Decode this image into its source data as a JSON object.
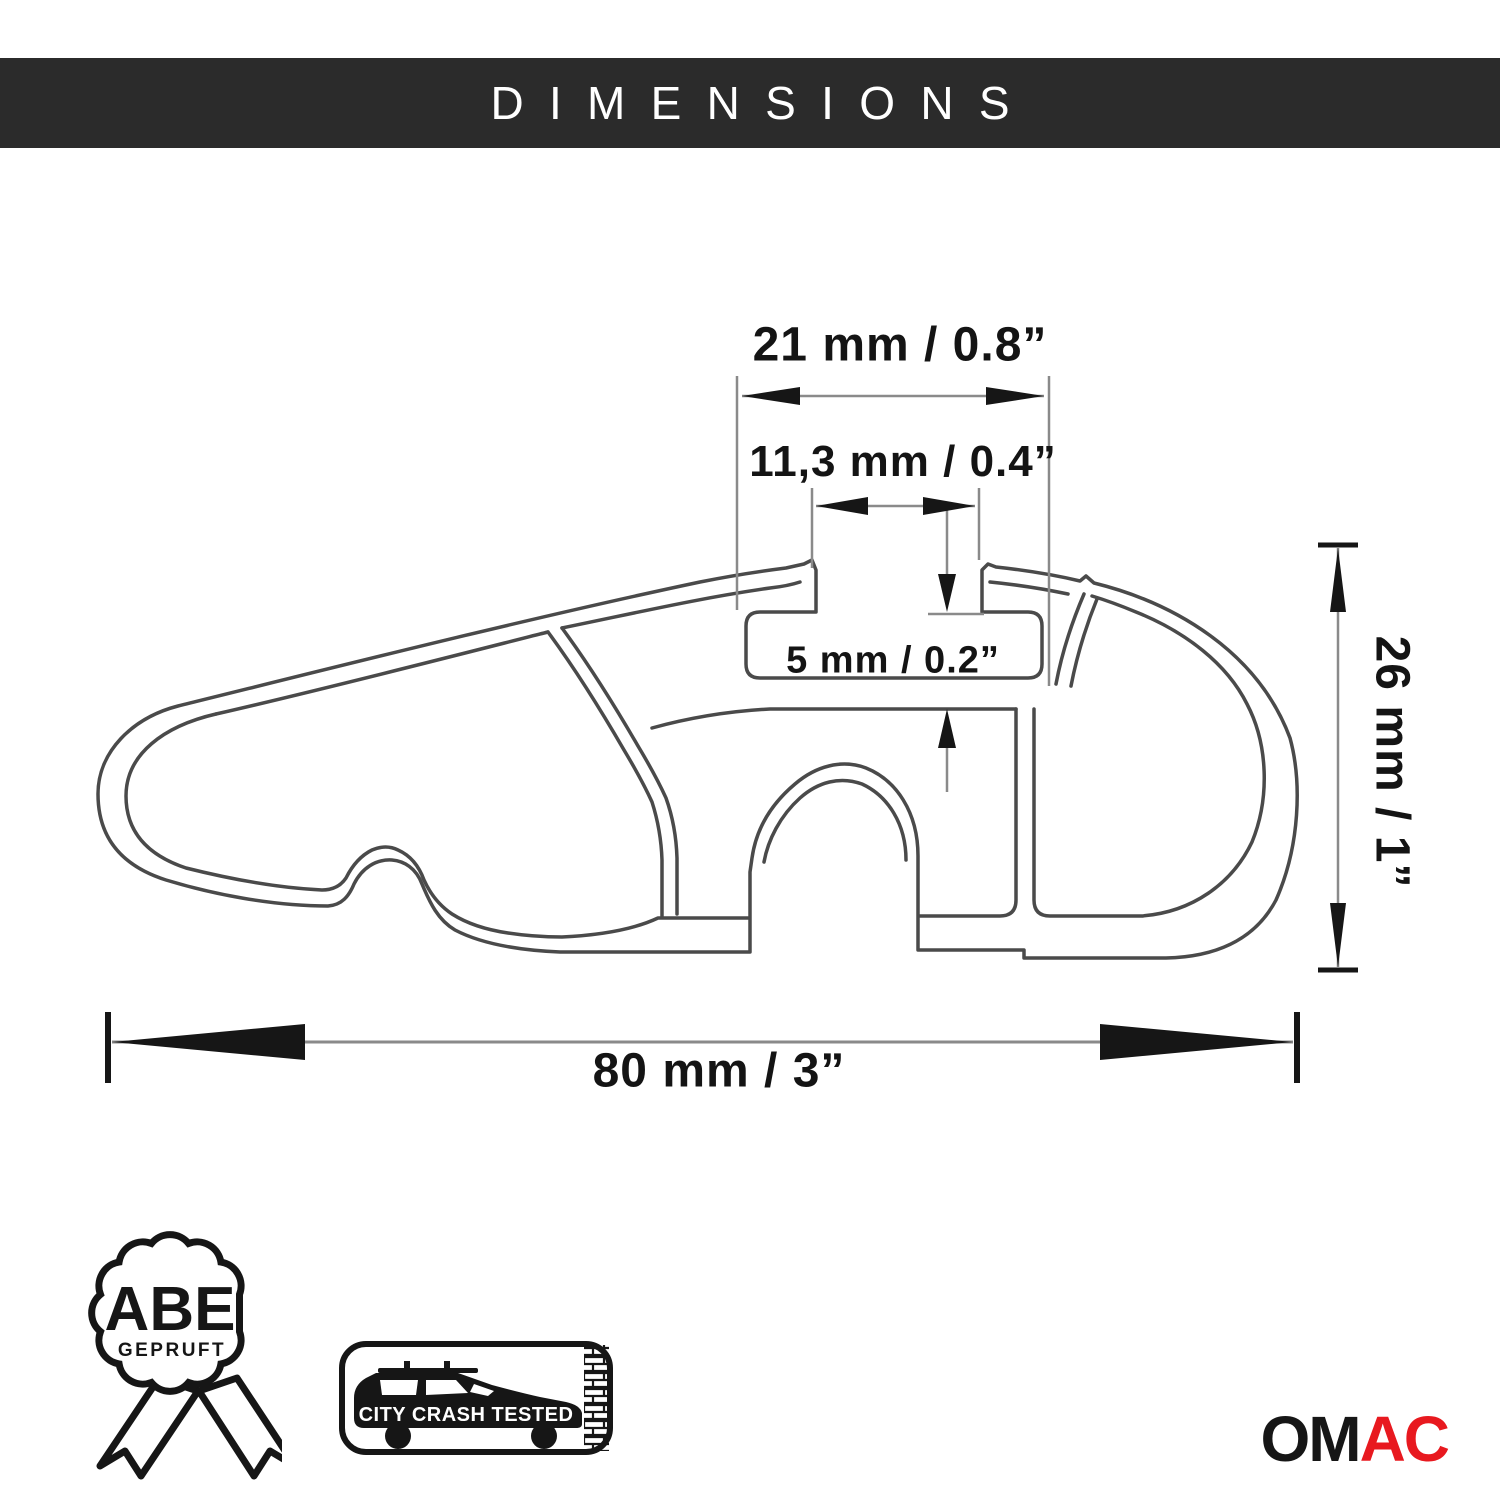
{
  "header": {
    "title": "DIMENSIONS"
  },
  "diagram": {
    "title": "Roof rack crossbar profile cross-section",
    "dims": {
      "slot_outer_width": "21 mm / 0.8”",
      "slot_opening_width": "11,3 mm / 0.4”",
      "floor_thickness": "5 mm / 0.2”",
      "profile_height": "26 mm / 1”",
      "profile_width": "80 mm / 3”"
    }
  },
  "badges": {
    "abe": {
      "title": "ABE",
      "subtitle": "GEPRUFT"
    },
    "crash": {
      "label": "CITY CRASH TESTED"
    }
  },
  "logo": {
    "black_part": "OM",
    "red_part": "AC"
  },
  "colors": {
    "header_bg": "#2b2b2b",
    "line_gray": "#4a4a4a",
    "aux_gray": "#8a8a8a",
    "arrow_black": "#161616",
    "brand_red": "#e8191f"
  }
}
